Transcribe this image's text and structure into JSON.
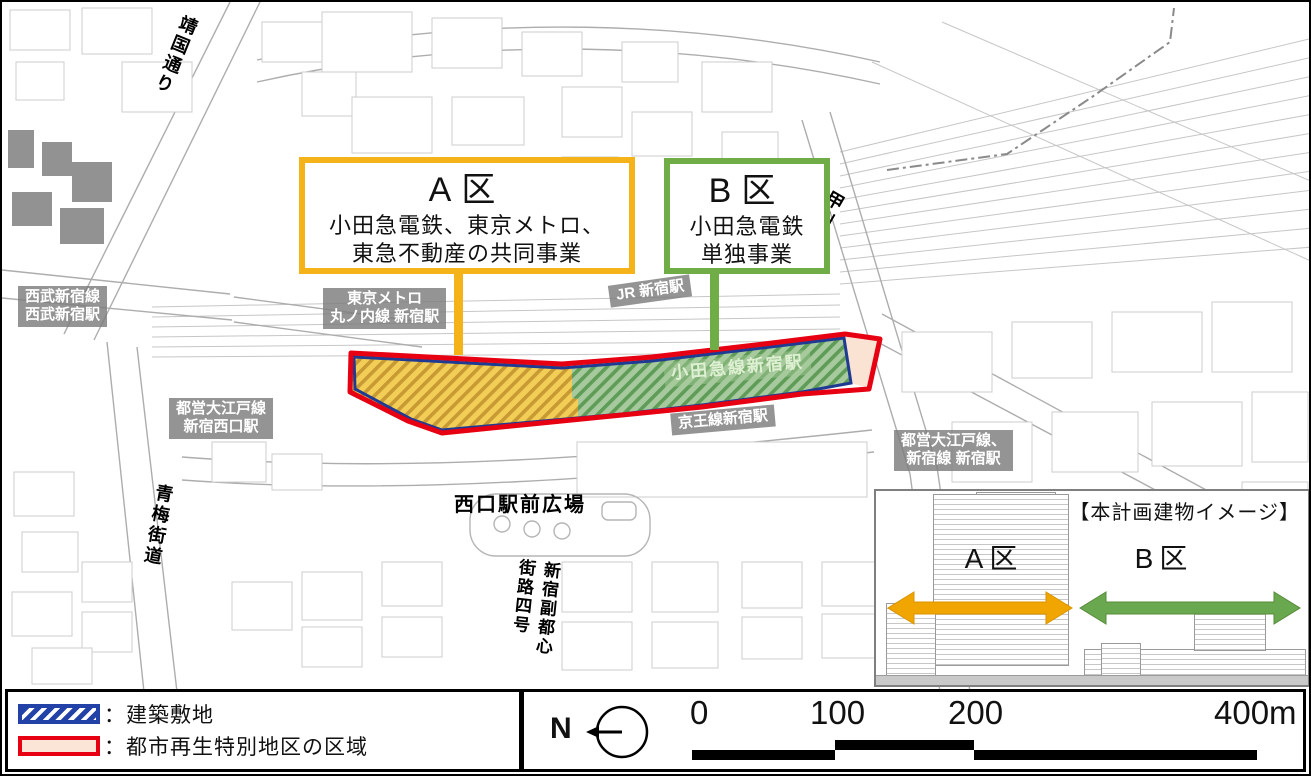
{
  "map": {
    "roads": {
      "yasukuni_dori": "靖国通り",
      "koshu_kaido": "甲州街道",
      "ome_kaido": "青梅街道",
      "fukutoshin_l1": "新宿副都心",
      "fukutoshin_l2": "街路四号",
      "west_plaza": "西口駅前広場"
    },
    "stations": {
      "seibu_l1": "西武新宿線",
      "seibu_l2": "西武新宿駅",
      "metro_l1": "東京メトロ",
      "metro_l2": "丸ノ内線 新宿駅",
      "jr": "JR 新宿駅",
      "oedo_west_l1": "都営大江戸線",
      "oedo_west_l2": "新宿西口駅",
      "keio": "京王線新宿駅",
      "odakyu": "小田急線新宿駅",
      "oedo_shinjuku_l1": "都営大江戸線、",
      "oedo_shinjuku_l2": "新宿線 新宿駅"
    },
    "callout_a": {
      "title": "A区",
      "line1": "小田急電鉄、東京メトロ、",
      "line2": "東急不動産の共同事業",
      "border_color": "#F5B31A"
    },
    "callout_b": {
      "title": "B区",
      "line1": "小田急電鉄",
      "line2": "単独事業",
      "border_color": "#70AD47"
    },
    "zone_colors": {
      "zone_a_hatch_bg": "#F3CE57",
      "zone_a_hatch_stripe": "#C79A33",
      "zone_b_hatch_bg": "#A6C99E",
      "zone_b_hatch_stripe": "#5F9C57",
      "district_fill": "#FAE3D3",
      "district_outline": "#E60012",
      "site_outline": "#1F3A93"
    }
  },
  "legend": {
    "building_site": "：建築敷地",
    "district": "：都市再生特別地区の区域"
  },
  "scalebar": {
    "north_label": "N",
    "tick0": "0",
    "tick100": "100",
    "tick200": "200",
    "tick400": "400m"
  },
  "inset": {
    "title": "【本計画建物イメージ】",
    "zone_a_label": "A区",
    "zone_b_label": "B区",
    "arrow_a_color": "#F0A500",
    "arrow_b_color": "#6AA84F"
  }
}
